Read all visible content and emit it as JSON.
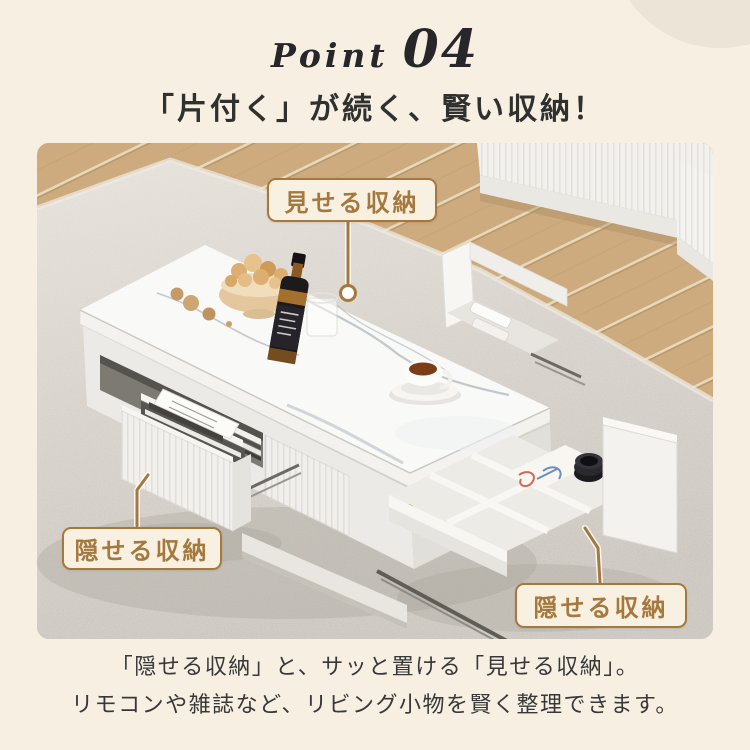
{
  "palette": {
    "background": "#f6efe2",
    "decor_circle": "#ece4d6",
    "accent_brown": "#a5783e",
    "badge_background": "#f8f0e1",
    "heading_text": "#30302f",
    "body_text": "#383838",
    "point_text": "#26262b"
  },
  "header": {
    "point_label": "Point",
    "point_number": "04",
    "heading": "「片付く」が続く、賢い収納！"
  },
  "photo": {
    "badges": [
      {
        "id": "show-storage",
        "label": "見せる収納"
      },
      {
        "id": "hide-storage-left",
        "label": "隠せる収納"
      },
      {
        "id": "hide-storage-right",
        "label": "隠せる収納"
      }
    ]
  },
  "caption": {
    "line1": "「隠せる収納」と、サッと置ける「見せる収納」。",
    "line2": "リモコンや雑誌など、リビング小物を賢く整理できます。"
  }
}
